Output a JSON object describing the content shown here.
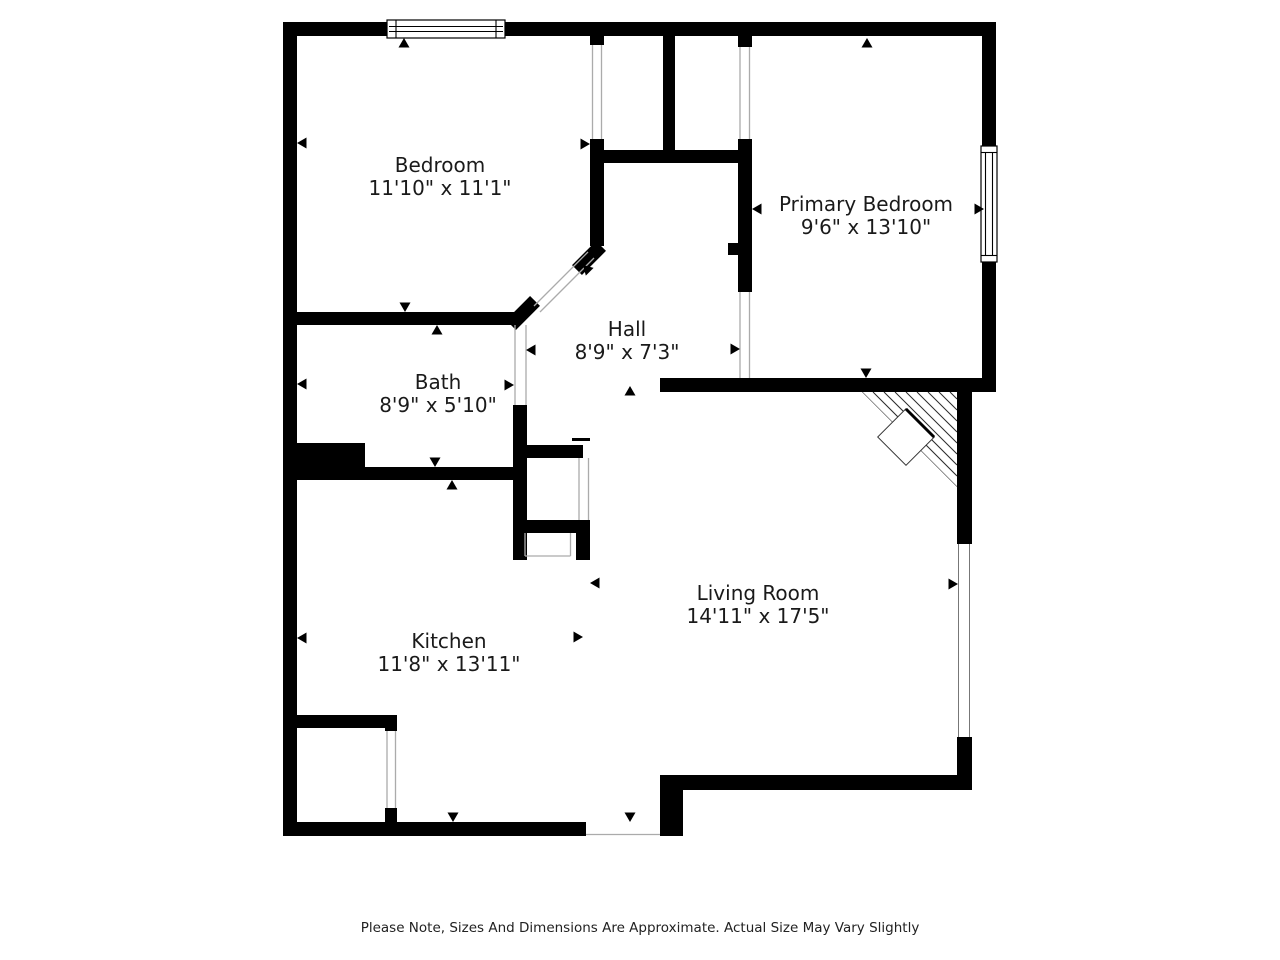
{
  "plan": {
    "rooms": {
      "bedroom": {
        "name": "Bedroom",
        "dims": "11'10\" x 11'1\""
      },
      "primary_bedroom": {
        "name": "Primary Bedroom",
        "dims": "9'6\" x 13'10\""
      },
      "hall": {
        "name": "Hall",
        "dims": "8'9\" x 7'3\""
      },
      "bath": {
        "name": "Bath",
        "dims": "8'9\" x 5'10\""
      },
      "kitchen": {
        "name": "Kitchen",
        "dims": "11'8\" x 13'11\""
      },
      "living_room": {
        "name": "Living Room",
        "dims": "14'11\" x 17'5\""
      }
    },
    "disclaimer": "Please Note, Sizes And Dimensions Are Approximate. Actual Size May Vary Slightly",
    "colors": {
      "wall": "#000000",
      "background": "#ffffff",
      "door_opening_line": "#ababab"
    }
  }
}
